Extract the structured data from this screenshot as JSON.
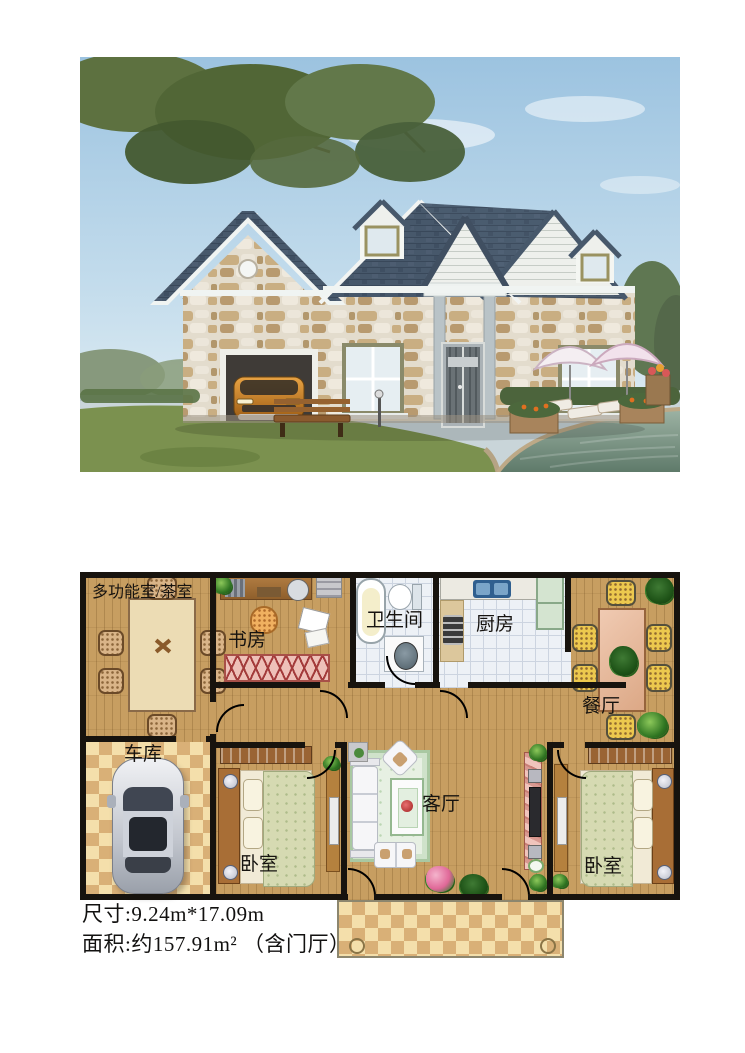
{
  "document": {
    "kind": "real-estate-house-plan-listing"
  },
  "photo": {
    "description": "exterior rendering of a single-story stone cottage with garage, lakeside garden",
    "colors": {
      "sky": "#9cc3e0",
      "roof": "#47586b",
      "stone_light": "#e3dccd",
      "stone_dark": "#b2976c",
      "trim_white": "#f0f4f2",
      "pavement": "#c9d5d9",
      "grass": "#7b914f",
      "water": "#5f7a6a",
      "car_orange": "#d4882a"
    }
  },
  "floor_plan": {
    "rooms": [
      {
        "label": "多功能室/茶室"
      },
      {
        "label": "书房"
      },
      {
        "label": "卫生间"
      },
      {
        "label": "厨房"
      },
      {
        "label": "餐厅"
      },
      {
        "label": "车库"
      },
      {
        "label": "卧室"
      },
      {
        "label": "客厅"
      },
      {
        "label": "卧室"
      }
    ],
    "colors": {
      "wood_floor": "#c79e61",
      "wall": "#17130e",
      "tile": "#edf1f6",
      "checker_light": "#f4dfab",
      "checker_dark": "#d9b077"
    }
  },
  "caption": {
    "line1": "尺寸:9.24m*17.09m",
    "line2": "面积:约157.91m² （含门厅）"
  }
}
